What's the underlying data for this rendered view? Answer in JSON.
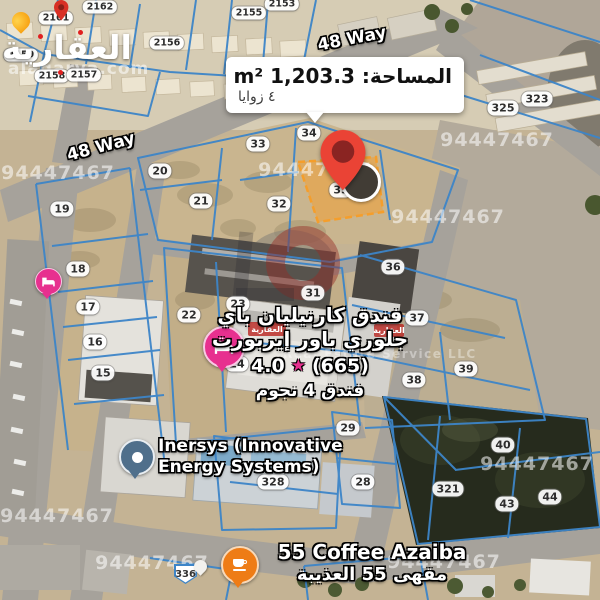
{
  "brand": {
    "name_arabic": "العقارية",
    "site": "alaqarya.com"
  },
  "info_box": {
    "area_label": "المساحة: m² 1,203.3",
    "corners_label": "٤ زوايا"
  },
  "road_labels": [
    {
      "text": "48 Way",
      "x": 101,
      "y": 147,
      "rot": -15
    },
    {
      "text": "48 Way",
      "x": 352,
      "y": 39,
      "rot": -11
    }
  ],
  "hotel": {
    "line1": "فندق كارنيليان باي",
    "line2": "جلوري باور إيربورت",
    "rating": "4.0",
    "star_icon": "★",
    "reviews": "(665)",
    "line4": "فندق 4 نجوم"
  },
  "inersys": {
    "line1": "Inersys (Innovative",
    "line2": "Energy Systems)"
  },
  "coffee": {
    "line1": "55 Coffee Azaiba",
    "line2": "مقهى 55 العذيبة"
  },
  "route_badge": {
    "text": "336"
  },
  "plot_labels": [
    {
      "text": "2162",
      "x": 100,
      "y": 7
    },
    {
      "text": "2161",
      "x": 56,
      "y": 18
    },
    {
      "text": "2155",
      "x": 249,
      "y": 13
    },
    {
      "text": "2153",
      "x": 282,
      "y": 4
    },
    {
      "text": "2156",
      "x": 167,
      "y": 43
    },
    {
      "text": "2159",
      "x": 21,
      "y": 55
    },
    {
      "text": "2158",
      "x": 52,
      "y": 76
    },
    {
      "text": "2157",
      "x": 84,
      "y": 75
    },
    {
      "text": "20",
      "x": 160,
      "y": 171
    },
    {
      "text": "33",
      "x": 258,
      "y": 144
    },
    {
      "text": "34",
      "x": 309,
      "y": 133
    },
    {
      "text": "35",
      "x": 341,
      "y": 190
    },
    {
      "text": "32",
      "x": 279,
      "y": 204
    },
    {
      "text": "21",
      "x": 201,
      "y": 201
    },
    {
      "text": "19",
      "x": 62,
      "y": 209
    },
    {
      "text": "18",
      "x": 78,
      "y": 269
    },
    {
      "text": "17",
      "x": 88,
      "y": 307
    },
    {
      "text": "16",
      "x": 95,
      "y": 342
    },
    {
      "text": "15",
      "x": 103,
      "y": 373
    },
    {
      "text": "22",
      "x": 189,
      "y": 315
    },
    {
      "text": "23",
      "x": 238,
      "y": 304
    },
    {
      "text": "24",
      "x": 237,
      "y": 364
    },
    {
      "text": "31",
      "x": 313,
      "y": 293
    },
    {
      "text": "36",
      "x": 393,
      "y": 267
    },
    {
      "text": "37",
      "x": 417,
      "y": 318
    },
    {
      "text": "38",
      "x": 414,
      "y": 380
    },
    {
      "text": "39",
      "x": 466,
      "y": 369
    },
    {
      "text": "29",
      "x": 348,
      "y": 428
    },
    {
      "text": "28",
      "x": 363,
      "y": 482
    },
    {
      "text": "40",
      "x": 503,
      "y": 445
    },
    {
      "text": "321",
      "x": 448,
      "y": 489
    },
    {
      "text": "43",
      "x": 507,
      "y": 504
    },
    {
      "text": "44",
      "x": 550,
      "y": 497
    },
    {
      "text": "325",
      "x": 503,
      "y": 108
    },
    {
      "text": "323",
      "x": 537,
      "y": 99
    },
    {
      "text": "328",
      "x": 273,
      "y": 482
    }
  ],
  "watermarks": [
    {
      "text": "94447467",
      "x": 58,
      "y": 173
    },
    {
      "text": "94447467",
      "x": 315,
      "y": 170
    },
    {
      "text": "94447467",
      "x": 497,
      "y": 140
    },
    {
      "text": "94447467",
      "x": 448,
      "y": 217
    },
    {
      "text": "94447467",
      "x": 57,
      "y": 516
    },
    {
      "text": "94447467",
      "x": 152,
      "y": 563
    },
    {
      "text": "94447467",
      "x": 444,
      "y": 562
    },
    {
      "text": "94447467",
      "x": 537,
      "y": 464
    }
  ],
  "watermark_llc": "Real Estate Service LLC",
  "colors": {
    "plot_line": "#3d85c8",
    "highlight_plot": "#f59e2b",
    "pin_red": "#ea4335",
    "hotel_pin_pink": "#e7308f",
    "coffee_pin_orange": "#ee7c16",
    "inersys_pin_gray": "#4f6f8b"
  }
}
